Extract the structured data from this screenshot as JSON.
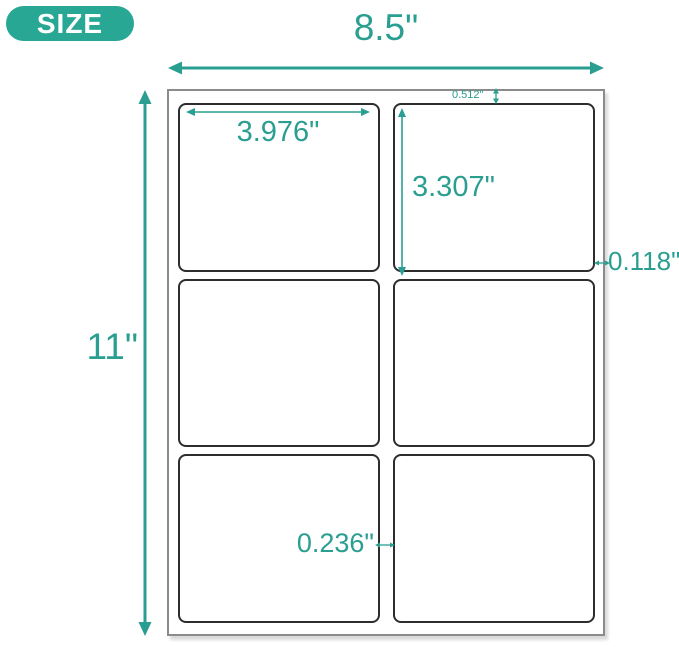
{
  "colors": {
    "accent": "#2A9E90",
    "badge_bg": "#29A795",
    "badge_text": "#FFFFFF",
    "sheet_border": "#8B8B8B",
    "label_border": "#2D2D2D",
    "background": "#FFFFFF"
  },
  "badge": {
    "label": "SIZE"
  },
  "diagram": {
    "sheet": {
      "width_label": "8.5\"",
      "height_label": "11\"",
      "columns": 2,
      "rows": 3,
      "label_count": 6
    },
    "measurements": {
      "label_width": "3.976\"",
      "label_height": "3.307\"",
      "top_margin": "0.512\"",
      "right_margin": "0.118\"",
      "column_gap": "0.236\""
    }
  }
}
